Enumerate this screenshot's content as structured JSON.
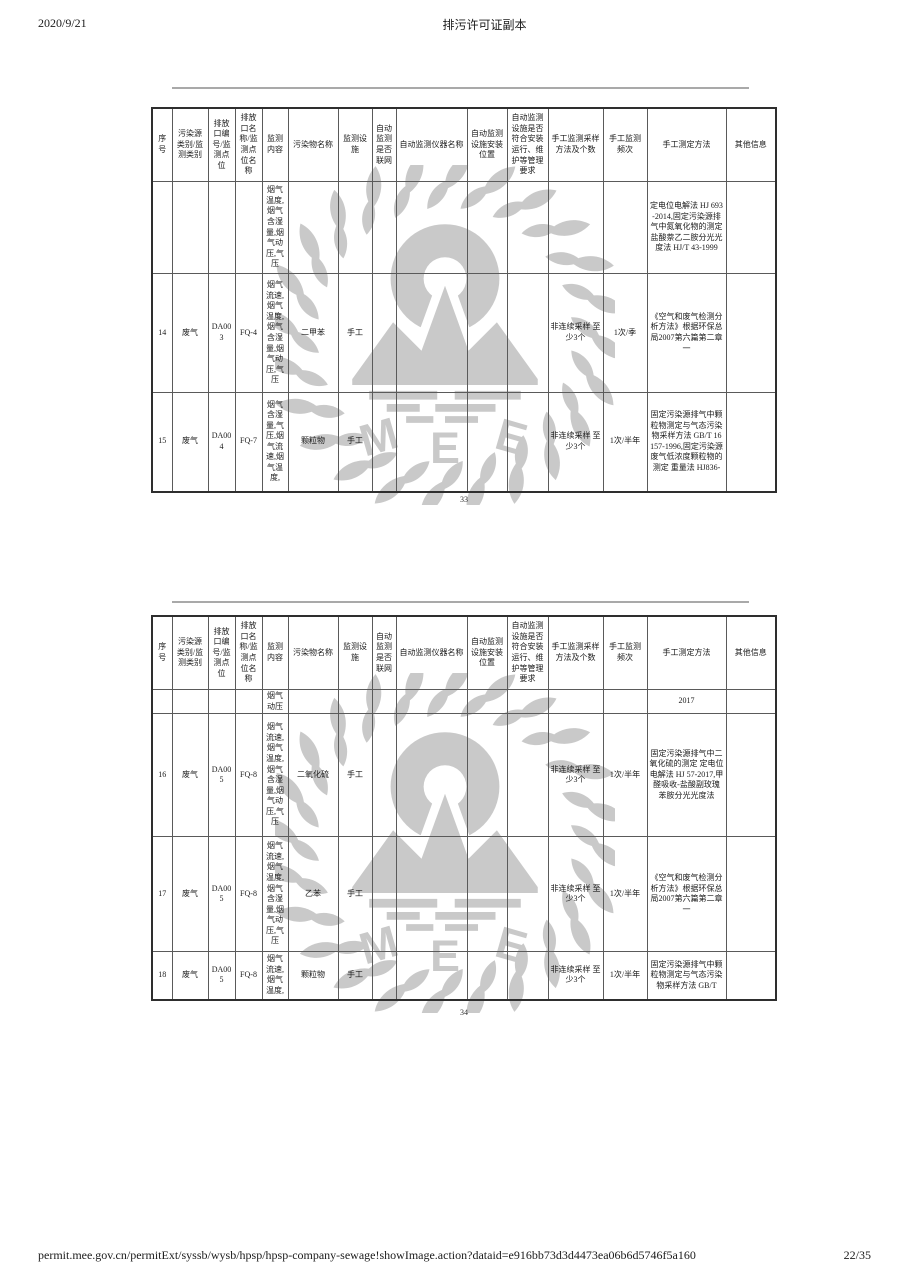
{
  "page": {
    "print_date": "2020/9/21",
    "doc_title": "排污许可证副本",
    "footer_url": "permit.mee.gov.cn/permitExt/syssb/wysb/hpsp/hpsp-company-sewage!showImage.action?dataid=e916bb73d3d4473ea06b6d5746f5a160",
    "footer_page": "22/35"
  },
  "watermark": {
    "label": "MEE",
    "color": "#c9c9c9"
  },
  "columns": [
    "序号",
    "污染源类别/监测类别",
    "排放口编号/监测点位",
    "排放口名称/监测点位名称",
    "监测内容",
    "污染物名称",
    "监测设施",
    "自动监测是否联网",
    "自动监测仪器名称",
    "自动监测设施安装位置",
    "自动监测设施是否符合安装运行、维护等管理要求",
    "手工监测采样方法及个数",
    "手工监测频次",
    "手工测定方法",
    "其他信息"
  ],
  "tables": [
    {
      "page_number": "33",
      "rows": [
        [
          "",
          "",
          "",
          "",
          "烟气温度,烟气含湿量,烟气动压,气压",
          "",
          "",
          "",
          "",
          "",
          "",
          "",
          "",
          "定电位电解法 HJ 693-2014,固定污染源排气中氮氧化物的测定 盐酸萘乙二胺分光光度法 HJ/T 43-1999",
          ""
        ],
        [
          "14",
          "废气",
          "DA003",
          "FQ-4",
          "烟气流速,烟气温度,烟气含湿量,烟气动压,气压",
          "二甲苯",
          "手工",
          "",
          "",
          "",
          "",
          "非连续采样 至少3个",
          "1次/季",
          "《空气和废气检测分析方法》根据环保总局2007第六篇第二章一",
          ""
        ],
        [
          "15",
          "废气",
          "DA004",
          "FQ-7",
          "烟气含湿量,气压,烟气流速,烟气温度,",
          "颗粒物",
          "手工",
          "",
          "",
          "",
          "",
          "非连续采样 至少3个",
          "1次/半年",
          "固定污染源排气中颗粒物测定与气态污染物采样方法 GB/T 16157-1996,固定污染源废气低浓度颗粒物的测定 重量法 HJ836-",
          ""
        ]
      ]
    },
    {
      "page_number": "34",
      "rows": [
        [
          "",
          "",
          "",
          "",
          "烟气动压",
          "",
          "",
          "",
          "",
          "",
          "",
          "",
          "",
          "2017",
          ""
        ],
        [
          "16",
          "废气",
          "DA005",
          "FQ-8",
          "烟气流速,烟气温度,烟气含湿量,烟气动压,气压",
          "二氧化硫",
          "手工",
          "",
          "",
          "",
          "",
          "非连续采样 至少3个",
          "1次/半年",
          "固定污染源排气中二氧化硫的测定 定电位电解法 HJ 57-2017,甲醛吸收-盐酸副玫瑰苯胺分光光度法",
          ""
        ],
        [
          "17",
          "废气",
          "DA005",
          "FQ-8",
          "烟气流速,烟气温度,烟气含湿量,烟气动压,气压",
          "乙苯",
          "手工",
          "",
          "",
          "",
          "",
          "非连续采样 至少3个",
          "1次/半年",
          "《空气和废气检测分析方法》根据环保总局2007第六篇第二章一",
          ""
        ],
        [
          "18",
          "废气",
          "DA005",
          "FQ-8",
          "烟气流速,烟气温度,",
          "颗粒物",
          "手工",
          "",
          "",
          "",
          "",
          "非连续采样 至少3个",
          "1次/半年",
          "固定污染源排气中颗粒物测定与气态污染物采样方法 GB/T",
          ""
        ]
      ]
    }
  ]
}
